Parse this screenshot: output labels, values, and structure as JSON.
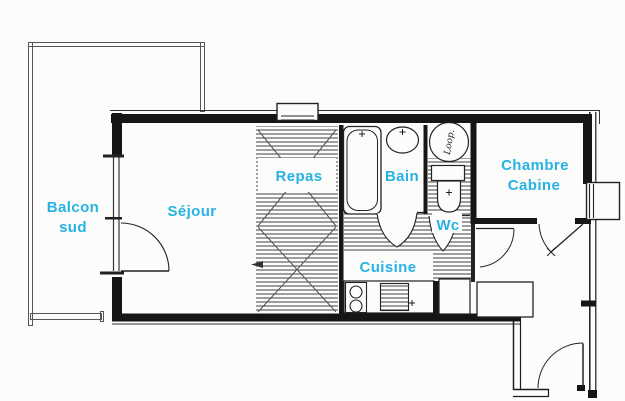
{
  "plan": {
    "type": "apartment-floor-plan",
    "rooms": {
      "balcony": {
        "line1": "Balcon",
        "line2": "sud"
      },
      "living": {
        "label": "Séjour"
      },
      "dining": {
        "label": "Repas"
      },
      "bath": {
        "label": "Bain"
      },
      "toilet": {
        "label": "Wc"
      },
      "kitchen": {
        "label": "Cuisine"
      },
      "bedroom": {
        "line1": "Chambre",
        "line2": "Cabine"
      }
    },
    "annotations": {
      "washer_scribble": "Loop."
    },
    "fixtures": [
      "bathtub",
      "washbasin",
      "washing-machine",
      "toilet",
      "cooktop",
      "oven",
      "kitchen-counter",
      "hall-cabinet",
      "window-box",
      "entrance-door"
    ],
    "colors": {
      "label": "#27b2e5",
      "wall": "#1a1a1a",
      "thin_line": "#444444",
      "hatch": "#3f3f3f",
      "background": "#fcfcfa"
    }
  }
}
